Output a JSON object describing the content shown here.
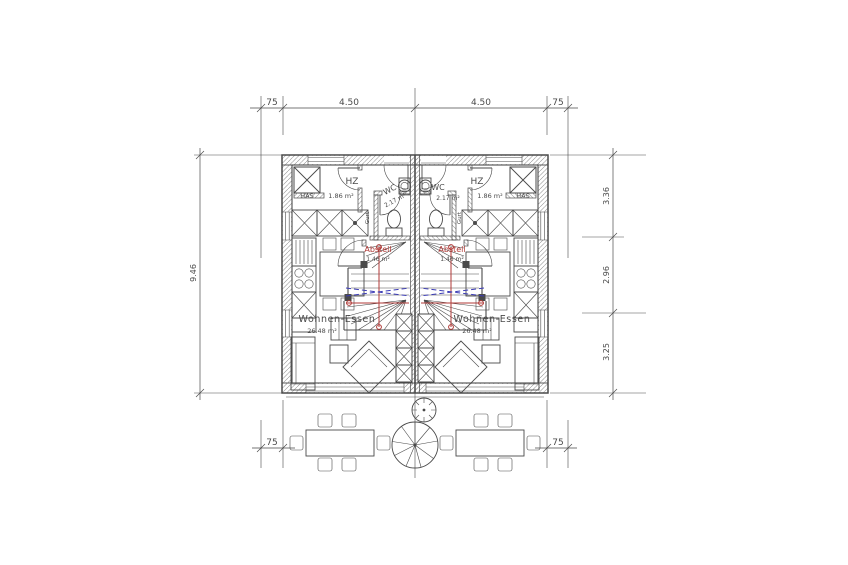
{
  "colors": {
    "line": "#4a4a4a",
    "red": "#b03a37",
    "blue": "#3b3bb5",
    "background": "#ffffff"
  },
  "dimensions": {
    "top": [
      "75",
      "4.50",
      "4.50",
      "75"
    ],
    "left": "9.46",
    "right": [
      "3.36",
      "2.96",
      "3.25"
    ],
    "bottom": [
      "75",
      "75"
    ]
  },
  "units": {
    "left": {
      "hz": "HZ",
      "has": "HAS",
      "hz_area": "1.86 m²",
      "wc": "WC",
      "wc_area": "2.17 m²",
      "abstell": "Abstell",
      "abstell_area": "1.46 m²",
      "living": "Wohnen-Essen",
      "living_area": "26.48 m²",
      "gurt": "Gurt"
    },
    "right": {
      "hz": "HZ",
      "has": "HAS",
      "hz_area": "1.86 m²",
      "wc": "WC",
      "wc_area": "2.17 m²",
      "abstell": "Abstell",
      "abstell_area": "1.46 m²",
      "living": "Wohnen-Essen",
      "living_area": "26.48 m²",
      "gurt": "Gurt"
    }
  }
}
